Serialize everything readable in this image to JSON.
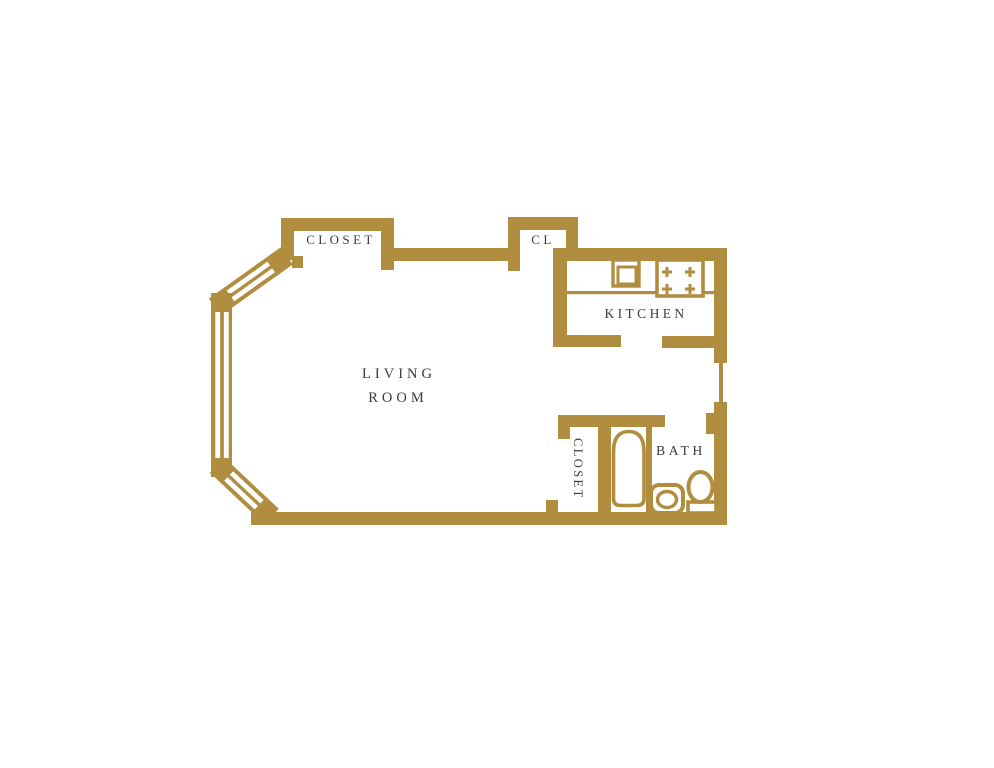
{
  "plan": {
    "title": "studio-apartment-floor-plan",
    "labels": {
      "closet_top": "CLOSET",
      "cl": "CL",
      "kitchen": "KITCHEN",
      "living_line1": "LIVING",
      "living_line2": "ROOM",
      "closet_bath": "CLOSET",
      "bath": "BATH"
    },
    "colors": {
      "wall": "#B08D3F",
      "label": "#3B3B3B",
      "background": "#FFFFFF"
    },
    "fixtures": [
      "bay-window",
      "kitchen-counter",
      "kitchen-sink",
      "stove",
      "entry-door",
      "bathtub",
      "bathroom-sink",
      "toilet"
    ]
  }
}
